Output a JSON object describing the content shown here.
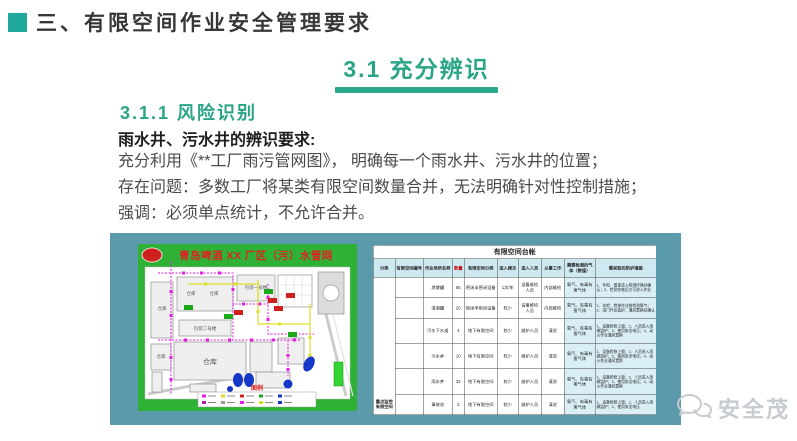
{
  "slide": {
    "title": "三、有限空间作业安全管理要求",
    "section": "3.1  充分辨识",
    "subsection": "3.1.1  风险识别",
    "requirement_heading": "雨水井、污水井的辨识要求:",
    "body_lines": [
      "充分利用《**工厂雨污管网图》， 明确每一个雨水井、污水井的位置；",
      "存在问题：多数工厂将某类有限空间数量合并，无法明确针对性控制措施；",
      "强调：必须单点统计，不允许合并。"
    ],
    "brand": "安全茂"
  },
  "colors": {
    "accent_teal": "#1fa99b",
    "section_green": "#2aa98a",
    "panel_teal": "#5b9aab",
    "map_green": "#2eb135",
    "map_title_red": "#e02222",
    "table_header_blue": "#cfe9f2"
  },
  "map_figure": {
    "title": "青岛啤酒 XX 厂区（污）水管网",
    "legend_title": "图例",
    "labels": [
      "仓库",
      "仓库",
      "仓库",
      "仓库",
      "包装二号楼",
      "包装一号楼",
      "仓库"
    ]
  },
  "ledger_table": {
    "title": "有限空间台帐",
    "headers": [
      "分类",
      "有限空间编号",
      "作业场所名称",
      "数量",
      "有限空间分类",
      "进入频次",
      "进入人员",
      "从事工作",
      "需要检测的气体（数值）",
      "需采取的防护措施"
    ],
    "category_label": "重点监控有限空间",
    "rows": [
      {
        "name": "发酵罐",
        "qty": "65",
        "type": "密闭半密闭设备",
        "freq": "1次/年",
        "people": "设备维检人员",
        "work": "内部维检",
        "gas": "氧气、有毒有害气体",
        "measures": "1、年检、普查进入检测环境并确认；2、检测合格后方可进入作业"
      },
      {
        "name": "清酒罐",
        "qty": "20",
        "type": "密闭半密闭设备",
        "freq": "较少",
        "people": "设备维检人员",
        "work": "内部维检",
        "gas": "氧气、有毒有害气体",
        "measures": "1、年检、检修作业前检测氧气；2、进门作业监护、通风置换后确认"
      },
      {
        "name": "污水下水道",
        "qty": "4",
        "type": "地下有限空间",
        "freq": "较少",
        "people": "维护人员",
        "work": "清淤",
        "gas": "氧气、有毒有害气体",
        "measures": "1、设备检修上锁；2、人员进入须做监护；3、使用安全电压；4、动火作业通风置换"
      },
      {
        "name": "污水井",
        "qty": "10",
        "type": "地下有限空间",
        "freq": "较少",
        "people": "维护人员",
        "work": "清淤",
        "gas": "氧气、有毒有害气体",
        "measures": "1、设备检修上锁；2、人员进入须做监护；3、使用安全电压；4、动火作业通风置换"
      },
      {
        "name": "雨水井",
        "qty": "32",
        "type": "地下有限空间",
        "freq": "较少",
        "people": "维护人员",
        "work": "清淤",
        "gas": "氧气、有毒有害气体",
        "measures": "1、设备检修上锁；2、人员进入须做监护；3、使用安全电压；4、动火作业通风置换"
      },
      {
        "name": "事故池",
        "qty": "2",
        "type": "地下有限空间",
        "freq": "较少",
        "people": "维护人员",
        "work": "清淤",
        "gas": "氧气、有毒有害气体",
        "measures": "1、设备检修上锁；2、人员进入须做监护；3、使用安全电压"
      }
    ]
  }
}
